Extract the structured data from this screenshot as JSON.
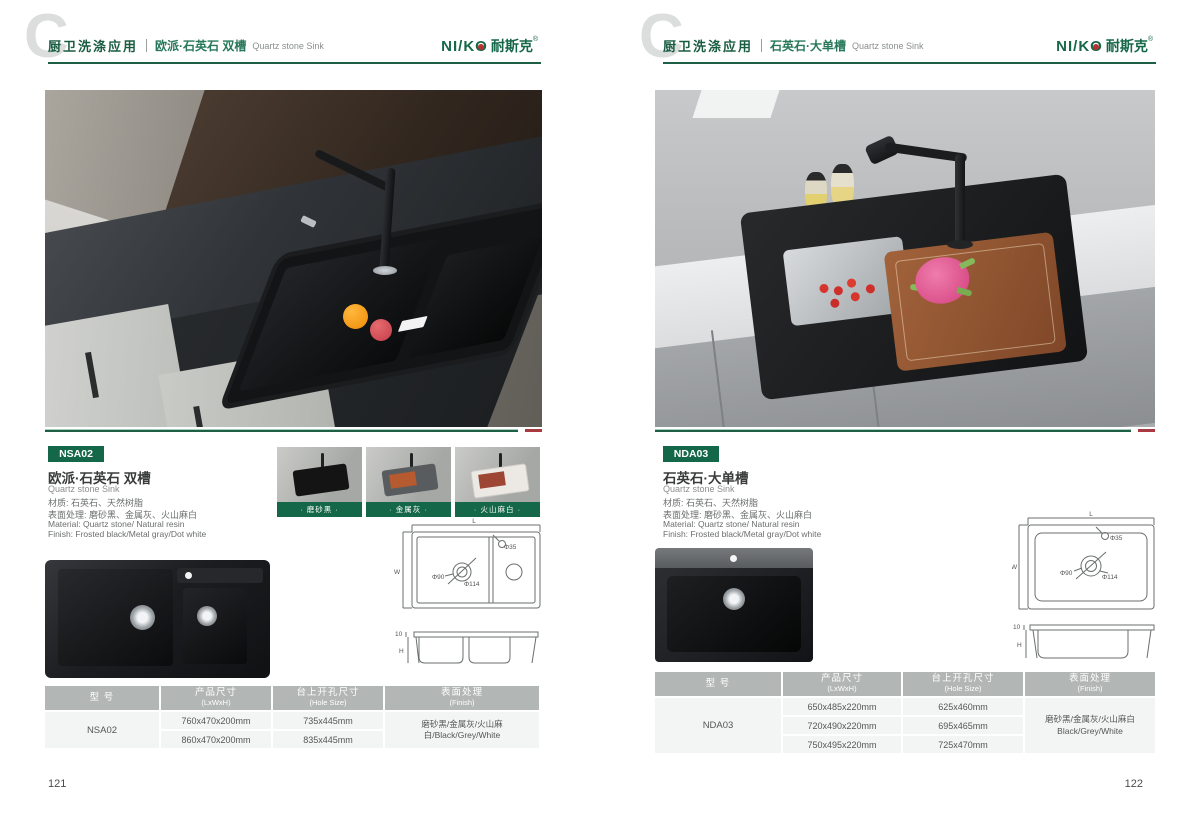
{
  "brand": {
    "logo_latin": "NI/K",
    "logo_o": "O",
    "logo_cn": "耐斯克",
    "reg": "®"
  },
  "pages": [
    {
      "header": {
        "watermark": "C",
        "category": "厨卫洗涤应用",
        "title_cn": "欧派·石英石 双槽",
        "title_en": "Quartz stone Sink"
      },
      "page_number": "121",
      "product": {
        "model": "NSA02",
        "title_cn": "欧派·石英石 双槽",
        "title_en": "Quartz stone Sink",
        "material_cn": "材质: 石英石、天然树脂",
        "finish_cn": "表面处理: 磨砂黑、金属灰、火山麻白",
        "material_en": "Material: Quartz stone/ Natural resin",
        "finish_en": "Finish: Frosted black/Metal gray/Dot white"
      },
      "swatches": [
        {
          "label": "· 磨砂黑 ·"
        },
        {
          "label": "· 金属灰 ·"
        },
        {
          "label": "· 火山麻白 ·"
        }
      ],
      "drawing": {
        "l": "L",
        "w": "W",
        "d35": "Φ35",
        "d90": "Φ90",
        "d114": "Φ114",
        "rim": "10",
        "h": "H"
      },
      "table": {
        "headers": [
          {
            "cn": "型 号",
            "en": ""
          },
          {
            "cn": "产品尺寸",
            "en": "(LxWxH)"
          },
          {
            "cn": "台上开孔尺寸",
            "en": "(Hole Size)"
          },
          {
            "cn": "表面处理",
            "en": "(Finish)"
          }
        ],
        "model": "NSA02",
        "rows": [
          {
            "size": "760x470x200mm",
            "hole": "735x445mm"
          },
          {
            "size": "860x470x200mm",
            "hole": "835x445mm"
          }
        ],
        "finish_line1": "磨砂黑/金属灰/火山麻白/Black/Grey/White"
      }
    },
    {
      "header": {
        "watermark": "C",
        "category": "厨卫洗涤应用",
        "title_cn": "石英石·大单槽",
        "title_en": "Quartz stone Sink"
      },
      "page_number": "122",
      "product": {
        "model": "NDA03",
        "title_cn": "石英石·大单槽",
        "title_en": "Quartz stone Sink",
        "material_cn": "材质: 石英石、天然树脂",
        "finish_cn": "表面处理: 磨砂黑、金属灰、火山麻白",
        "material_en": "Material: Quartz stone/ Natural resin",
        "finish_en": "Finish: Frosted black/Metal gray/Dot white"
      },
      "drawing": {
        "l": "L",
        "w": "W",
        "d35": "Φ35",
        "d90": "Φ90",
        "d114": "Φ114",
        "rim": "10",
        "h": "H"
      },
      "table": {
        "headers": [
          {
            "cn": "型 号",
            "en": ""
          },
          {
            "cn": "产品尺寸",
            "en": "(LxWxH)"
          },
          {
            "cn": "台上开孔尺寸",
            "en": "(Hole Size)"
          },
          {
            "cn": "表面处理",
            "en": "(Finish)"
          }
        ],
        "model": "NDA03",
        "rows": [
          {
            "size": "650x485x220mm",
            "hole": "625x460mm"
          },
          {
            "size": "720x490x220mm",
            "hole": "695x465mm"
          },
          {
            "size": "750x495x220mm",
            "hole": "725x470mm"
          }
        ],
        "finish_line1": "磨砂黑/金属灰/火山麻白",
        "finish_line2": "Black/Grey/White"
      }
    }
  ]
}
